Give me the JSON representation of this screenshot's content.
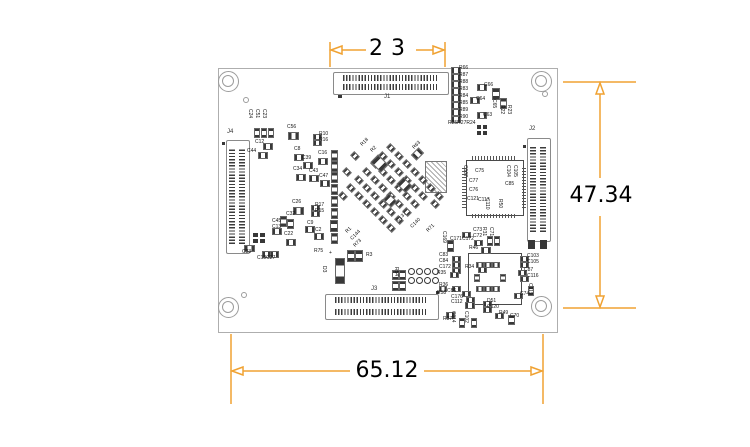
{
  "colors": {
    "dimension": "#F0A232",
    "silkscreen": "#151515",
    "board_outline": "#aeaeae",
    "pad": "#383838"
  },
  "dimensions": {
    "top": {
      "value": "23"
    },
    "right": {
      "value": "47.34"
    },
    "bottom": {
      "value": "65.12"
    }
  },
  "board": {
    "outline": {
      "x": 218,
      "y": 68,
      "w": 338,
      "h": 263
    },
    "mounting_holes": [
      [
        229,
        82
      ],
      [
        542,
        82
      ],
      [
        229,
        308
      ],
      [
        542,
        307
      ]
    ],
    "vias": [
      [
        246,
        100
      ],
      [
        244,
        295
      ],
      [
        545,
        94
      ]
    ],
    "connectors": [
      {
        "label": "J1",
        "x": 333,
        "y": 72,
        "w": 114,
        "h": 21,
        "o": "h",
        "lx": 384,
        "ly": 94
      },
      {
        "label": "J2",
        "x": 527,
        "y": 138,
        "w": 22,
        "h": 102,
        "o": "v",
        "lx": 529,
        "ly": 126
      },
      {
        "label": "J3",
        "x": 325,
        "y": 294,
        "w": 112,
        "h": 24,
        "o": "h",
        "lx": 371,
        "ly": 286
      },
      {
        "label": "J4",
        "x": 226,
        "y": 140,
        "w": 22,
        "h": 112,
        "o": "v",
        "lx": 227,
        "ly": 129
      }
    ],
    "ics": [
      {
        "name": "qfp-ic",
        "x": 466,
        "y": 160,
        "w": 56,
        "h": 54,
        "pins": true
      },
      {
        "name": "bottom-right-ic",
        "x": 468,
        "y": 253,
        "w": 52,
        "h": 50,
        "pins": false
      }
    ],
    "qfn": {
      "x": 425,
      "y": 161,
      "w": 20,
      "h": 30
    },
    "component_labels": [
      [
        "R66",
        459,
        66
      ],
      [
        "R87",
        459,
        73
      ],
      [
        "R88",
        459,
        80
      ],
      [
        "R83",
        459,
        87
      ],
      [
        "R84",
        459,
        94
      ],
      [
        "R85",
        459,
        101
      ],
      [
        "R89",
        459,
        108
      ],
      [
        "R90",
        459,
        115
      ],
      [
        "R25R27R24",
        448,
        121
      ],
      [
        "C66",
        484,
        83
      ],
      [
        "C64",
        476,
        97
      ],
      [
        "C63",
        483,
        113
      ],
      [
        "C65",
        496,
        99,
        90
      ],
      [
        "R22",
        504,
        105,
        90
      ],
      [
        "R23",
        511,
        105,
        90
      ],
      [
        "C24",
        252,
        109,
        90
      ],
      [
        "C51",
        259,
        109,
        90
      ],
      [
        "C23",
        266,
        109,
        90
      ],
      [
        "C12",
        255,
        140
      ],
      [
        "C44",
        247,
        149
      ],
      [
        "C56",
        287,
        125
      ],
      [
        "C8",
        294,
        147
      ],
      [
        "R10",
        319,
        132
      ],
      [
        "R16",
        319,
        138
      ],
      [
        "C39",
        302,
        156
      ],
      [
        "C16",
        318,
        151
      ],
      [
        "C34",
        293,
        167
      ],
      [
        "C43",
        309,
        169
      ],
      [
        "C47",
        319,
        174
      ],
      [
        "C26",
        292,
        200
      ],
      [
        "R17",
        315,
        203
      ],
      [
        "R15",
        315,
        209
      ],
      [
        "C32",
        286,
        212
      ],
      [
        "C45",
        272,
        219
      ],
      [
        "C13",
        272,
        225
      ],
      [
        "C22",
        284,
        232
      ],
      [
        "C9",
        307,
        221
      ],
      [
        "C2",
        315,
        228
      ],
      [
        "C33",
        242,
        250
      ],
      [
        "C18C27",
        257,
        256
      ],
      [
        "R75",
        314,
        249
      ],
      [
        "D3",
        326,
        266,
        90
      ],
      [
        "+",
        329,
        251
      ],
      [
        "R18",
        360,
        144,
        -45
      ],
      [
        "R2",
        370,
        150,
        -45
      ],
      [
        "R63",
        412,
        147,
        -45
      ],
      [
        "C137",
        396,
        220,
        -45
      ],
      [
        "C140",
        410,
        226,
        -45
      ],
      [
        "R71",
        426,
        230,
        -45
      ],
      [
        "R73",
        353,
        245,
        -45
      ],
      [
        "R3",
        366,
        253
      ],
      [
        "R1",
        345,
        231,
        -45
      ],
      [
        "C144",
        350,
        238,
        -45
      ],
      [
        "C169",
        446,
        231,
        90
      ],
      [
        "C171",
        450,
        237
      ],
      [
        "C172",
        462,
        237
      ],
      [
        "C73",
        473,
        228
      ],
      [
        "C72",
        473,
        234
      ],
      [
        "R31",
        486,
        227,
        90
      ],
      [
        "C71",
        493,
        227,
        90
      ],
      [
        "C107",
        467,
        165,
        90
      ],
      [
        "C75",
        475,
        169
      ],
      [
        "C77",
        469,
        179
      ],
      [
        "C76",
        469,
        188
      ],
      [
        "C121",
        467,
        197
      ],
      [
        "C117",
        478,
        198
      ],
      [
        "C110",
        489,
        198,
        90
      ],
      [
        "R50",
        502,
        199,
        90
      ],
      [
        "C85",
        505,
        182
      ],
      [
        "C104",
        510,
        165,
        90
      ],
      [
        "C105",
        517,
        165,
        90
      ],
      [
        "C83",
        439,
        253
      ],
      [
        "C84",
        439,
        259
      ],
      [
        "C172",
        439,
        265
      ],
      [
        "R35",
        437,
        271
      ],
      [
        "R36",
        439,
        283
      ],
      [
        "C86",
        447,
        289
      ],
      [
        "C176",
        451,
        295
      ],
      [
        "R46",
        469,
        246
      ],
      [
        "R34",
        465,
        265
      ],
      [
        "C103",
        527,
        254
      ],
      [
        "C105",
        527,
        260
      ],
      [
        "C87",
        524,
        268
      ],
      [
        "C116",
        527,
        274
      ],
      [
        "C119",
        532,
        283,
        90
      ],
      [
        "C74",
        520,
        292
      ],
      [
        "C112",
        451,
        300
      ],
      [
        "D51",
        487,
        299
      ],
      [
        "C120",
        487,
        305
      ],
      [
        "R49",
        499,
        311
      ],
      [
        "C70",
        510,
        314
      ],
      [
        "C114",
        455,
        311,
        90
      ],
      [
        "C102",
        468,
        311,
        90
      ],
      [
        "R37",
        443,
        317
      ],
      [
        "R58",
        437,
        291
      ],
      [
        "R54",
        398,
        267,
        90
      ]
    ],
    "chips": [
      [
        451,
        67,
        8,
        5
      ],
      [
        451,
        74,
        8,
        5
      ],
      [
        451,
        81,
        8,
        5
      ],
      [
        451,
        88,
        8,
        5
      ],
      [
        451,
        95,
        8,
        5
      ],
      [
        451,
        102,
        8,
        5
      ],
      [
        451,
        109,
        8,
        5
      ],
      [
        451,
        116,
        8,
        5
      ],
      [
        477,
        84,
        8,
        5
      ],
      [
        470,
        97,
        8,
        5
      ],
      [
        477,
        112,
        8,
        5
      ],
      [
        492,
        88,
        6,
        10
      ],
      [
        500,
        98,
        5,
        9
      ],
      [
        254,
        128,
        4,
        8
      ],
      [
        261,
        128,
        4,
        8
      ],
      [
        268,
        128,
        4,
        8
      ],
      [
        263,
        143,
        8,
        5
      ],
      [
        258,
        152,
        8,
        5
      ],
      [
        288,
        132,
        9,
        6
      ],
      [
        294,
        154,
        8,
        5
      ],
      [
        313,
        134,
        7,
        4
      ],
      [
        313,
        140,
        7,
        4
      ],
      [
        303,
        162,
        8,
        5
      ],
      [
        318,
        158,
        8,
        5
      ],
      [
        296,
        174,
        8,
        5
      ],
      [
        309,
        175,
        8,
        5
      ],
      [
        320,
        180,
        8,
        5
      ],
      [
        293,
        207,
        9,
        6
      ],
      [
        311,
        205,
        7,
        4
      ],
      [
        311,
        211,
        7,
        4
      ],
      [
        280,
        216,
        5,
        9
      ],
      [
        272,
        228,
        8,
        5
      ],
      [
        287,
        219,
        5,
        8
      ],
      [
        286,
        239,
        8,
        5
      ],
      [
        305,
        226,
        8,
        5
      ],
      [
        314,
        233,
        8,
        5
      ],
      [
        244,
        245,
        9,
        5
      ],
      [
        262,
        251,
        7,
        5
      ],
      [
        270,
        251,
        7,
        5
      ],
      [
        331,
        150,
        5,
        9
      ],
      [
        331,
        161,
        5,
        9
      ],
      [
        331,
        172,
        5,
        9
      ],
      [
        331,
        184,
        5,
        9
      ],
      [
        331,
        196,
        5,
        9
      ],
      [
        331,
        208,
        5,
        9
      ],
      [
        330,
        220,
        6,
        10
      ],
      [
        331,
        233,
        5,
        9
      ],
      [
        335,
        258,
        8,
        24
      ],
      [
        347,
        250,
        6,
        10
      ],
      [
        355,
        250,
        6,
        10
      ],
      [
        392,
        270,
        5,
        8
      ],
      [
        399,
        270,
        5,
        8
      ],
      [
        392,
        281,
        5,
        8
      ],
      [
        399,
        281,
        5,
        8
      ],
      [
        387,
        145,
        6,
        4,
        45
      ],
      [
        379,
        153,
        6,
        4,
        45
      ],
      [
        395,
        153,
        6,
        4,
        45
      ],
      [
        371,
        161,
        6,
        4,
        45
      ],
      [
        387,
        161,
        6,
        4,
        45
      ],
      [
        403,
        161,
        6,
        4,
        45
      ],
      [
        363,
        169,
        6,
        4,
        45
      ],
      [
        379,
        169,
        6,
        4,
        45
      ],
      [
        395,
        169,
        6,
        4,
        45
      ],
      [
        411,
        169,
        6,
        4,
        45
      ],
      [
        355,
        177,
        6,
        4,
        45
      ],
      [
        371,
        177,
        6,
        4,
        45
      ],
      [
        387,
        177,
        6,
        4,
        45
      ],
      [
        403,
        177,
        6,
        4,
        45
      ],
      [
        419,
        177,
        6,
        4,
        45
      ],
      [
        347,
        185,
        6,
        4,
        45
      ],
      [
        363,
        185,
        6,
        4,
        45
      ],
      [
        379,
        185,
        6,
        4,
        45
      ],
      [
        395,
        185,
        6,
        4,
        45
      ],
      [
        411,
        185,
        6,
        4,
        45
      ],
      [
        427,
        185,
        6,
        4,
        45
      ],
      [
        355,
        193,
        6,
        4,
        45
      ],
      [
        371,
        193,
        6,
        4,
        45
      ],
      [
        387,
        193,
        6,
        4,
        45
      ],
      [
        403,
        193,
        6,
        4,
        45
      ],
      [
        419,
        193,
        6,
        4,
        45
      ],
      [
        363,
        201,
        6,
        4,
        45
      ],
      [
        379,
        201,
        6,
        4,
        45
      ],
      [
        395,
        201,
        6,
        4,
        45
      ],
      [
        411,
        201,
        6,
        4,
        45
      ],
      [
        371,
        209,
        6,
        4,
        45
      ],
      [
        387,
        209,
        6,
        4,
        45
      ],
      [
        403,
        209,
        6,
        4,
        45
      ],
      [
        339,
        193,
        6,
        4,
        45
      ],
      [
        435,
        193,
        6,
        4,
        45
      ],
      [
        351,
        153,
        6,
        4,
        45
      ],
      [
        343,
        169,
        6,
        4,
        45
      ],
      [
        431,
        201,
        6,
        4,
        45
      ],
      [
        379,
        217,
        6,
        4,
        45
      ],
      [
        395,
        217,
        6,
        4,
        45
      ],
      [
        387,
        225,
        6,
        4,
        45
      ],
      [
        372,
        158,
        13,
        9,
        45
      ],
      [
        398,
        180,
        11,
        8,
        45
      ],
      [
        384,
        196,
        10,
        7,
        45
      ],
      [
        412,
        150,
        9,
        6,
        -45
      ],
      [
        462,
        232,
        7,
        4
      ],
      [
        474,
        240,
        7,
        4
      ],
      [
        487,
        236,
        4,
        8
      ],
      [
        494,
        236,
        4,
        8
      ],
      [
        447,
        240,
        5,
        10
      ],
      [
        452,
        256,
        7,
        4
      ],
      [
        452,
        262,
        7,
        4
      ],
      [
        452,
        268,
        7,
        4
      ],
      [
        450,
        272,
        7,
        4
      ],
      [
        452,
        286,
        7,
        4
      ],
      [
        462,
        291,
        7,
        4
      ],
      [
        466,
        297,
        7,
        4
      ],
      [
        481,
        247,
        8,
        5
      ],
      [
        478,
        267,
        7,
        4
      ],
      [
        520,
        256,
        7,
        4
      ],
      [
        520,
        262,
        7,
        4
      ],
      [
        518,
        270,
        7,
        4
      ],
      [
        520,
        276,
        7,
        4
      ],
      [
        528,
        286,
        4,
        8
      ],
      [
        514,
        293,
        7,
        4
      ],
      [
        465,
        302,
        8,
        5
      ],
      [
        483,
        301,
        7,
        4
      ],
      [
        483,
        307,
        7,
        4
      ],
      [
        495,
        313,
        7,
        4
      ],
      [
        508,
        315,
        5,
        8
      ],
      [
        459,
        318,
        4,
        8
      ],
      [
        471,
        318,
        4,
        8
      ],
      [
        446,
        312,
        7,
        5
      ],
      [
        439,
        286,
        6,
        4
      ],
      [
        476,
        262,
        6,
        4
      ],
      [
        484,
        262,
        6,
        4
      ],
      [
        492,
        262,
        6,
        4
      ],
      [
        476,
        286,
        6,
        4
      ],
      [
        484,
        286,
        6,
        4
      ],
      [
        492,
        286,
        6,
        4
      ],
      [
        474,
        274,
        4,
        6
      ],
      [
        500,
        274,
        4,
        6
      ]
    ],
    "dark_pads": [
      [
        477,
        125,
        4,
        4
      ],
      [
        483,
        125,
        4,
        4
      ],
      [
        477,
        131,
        4,
        4
      ],
      [
        483,
        131,
        4,
        4
      ],
      [
        253,
        233,
        5,
        4
      ],
      [
        260,
        233,
        5,
        4
      ],
      [
        253,
        239,
        5,
        4
      ],
      [
        260,
        239,
        5,
        4
      ],
      [
        528,
        240,
        7,
        9
      ],
      [
        540,
        240,
        7,
        9
      ],
      [
        338,
        95,
        4,
        3
      ],
      [
        222,
        142,
        3,
        3
      ],
      [
        436,
        291,
        3,
        3
      ],
      [
        523,
        145,
        3,
        3
      ]
    ],
    "round_pads": [
      [
        412,
        272
      ],
      [
        420,
        272
      ],
      [
        428,
        272
      ],
      [
        436,
        272
      ],
      [
        412,
        281
      ],
      [
        420,
        281
      ],
      [
        428,
        281
      ],
      [
        436,
        281
      ]
    ]
  }
}
